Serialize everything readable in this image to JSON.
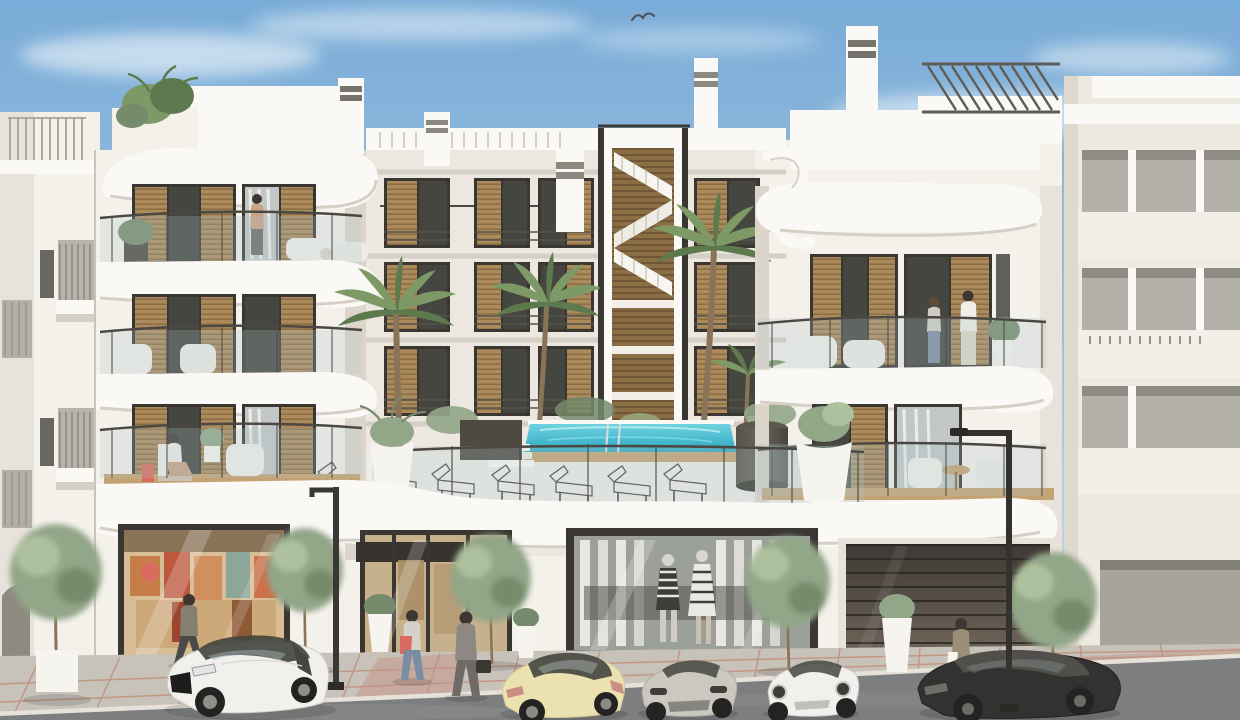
{
  "meta": {
    "title": "Architectural rendering — modern white Mediterranean apartment building, street view",
    "style": "3D exterior visualization, daytime, clear sky"
  },
  "palette": {
    "sky-top": "#79ACD8",
    "sky-mid": "#A3C4DF",
    "sky-low": "#D7E4EC",
    "cloud": "#FFFFFF",
    "wall": "#F4F1EB",
    "wall-bright": "#FBF9F6",
    "wall-shade": "#E7E2DA",
    "wall-dark": "#D5CFC5",
    "recess": "#ECE7DF",
    "frame": "#3A3733",
    "wood": "#AD8A5B",
    "wood-dark": "#8C6E45",
    "glass-dark": "#44463F",
    "glass-light": "#C2C7C6",
    "curtain": "#E9E9E6",
    "rail": "#4B4843",
    "railing-glass": "#AFC4C8",
    "pool-top": "#6FD2E0",
    "pool-deep": "#2EA8C4",
    "deck-wood": "#C5A272",
    "planter-dark": "#4E4A42",
    "pot-white": "#F6F4EF",
    "tree-green": "#92A688",
    "tree-light": "#AEC19E",
    "tree-dark": "#768B6B",
    "palm-green": "#7C9966",
    "palm-dark": "#5D7A4E",
    "trunk": "#8A7459",
    "asphalt": "#7C7E7F",
    "sidewalk": "#C8C3BA",
    "curb": "#E6E2D9",
    "red-line": "#BE8168",
    "red-pave": "#C49286",
    "car-white": "#F1F0ED",
    "car-cream": "#ECE2B0",
    "car-silver": "#CBC8C0",
    "car-dark": "#343230",
    "tire": "#242322",
    "garage-top": "#3E3933",
    "garage-bottom": "#70655A",
    "skin": "#C9A385",
    "hair": "#3E3630",
    "denim": "#7A8DA3",
    "suit": "#8D8982",
    "coral": "#D96A5F"
  },
  "scene": {
    "sky": {
      "clouds": 7,
      "birds": 1
    },
    "buildings": {
      "left_neighbor": "white building with juliet balconies and arched doorway",
      "main_left_wing": "4-storey white wing, curved balcony slabs, wood louvre shutters",
      "courtyard": "recessed core with wood-slat staircase tower, chimneys and palm trees",
      "pool_terrace": "first-floor terrace with turquoise pool, wood rim, glass railing",
      "main_right_wing": "3-storey white wing with roof pergola and curled parapet ribbon",
      "right_neighbor": "cream building with recessed grey loggias"
    },
    "pool_terrace": {
      "sun_loungers": 7,
      "dark_planters": 2,
      "white_pots": 2,
      "steps": 3
    },
    "storefronts": [
      {
        "name": "boutique-left",
        "content": "colourful clothing display"
      },
      {
        "name": "gallery-passage",
        "content": "glazed entrance with dark fascia board"
      },
      {
        "name": "fashion-store-center",
        "content": "two mannequins in striped outfits"
      }
    ],
    "garage_doors": 1,
    "cars": [
      {
        "name": "white-hatchback",
        "view": "front-left"
      },
      {
        "name": "cream-sports-sedan",
        "view": "rear-left"
      },
      {
        "name": "silver-car",
        "view": "front"
      },
      {
        "name": "white-coupe",
        "view": "front"
      },
      {
        "name": "dark-sedan",
        "view": "front-left"
      }
    ],
    "people": {
      "street": 4,
      "balconies": [
        "standing person top-left balcony",
        "seated person lower-left balcony",
        "couple on right-wing balcony"
      ]
    },
    "vegetation": {
      "street_trees": 5,
      "palm_trees": 4,
      "potted_plants": 6,
      "rooftop_plants": 1
    },
    "street": {
      "lamps": 2,
      "paving": "grey slabs with red joint lines, red paved zones"
    }
  }
}
